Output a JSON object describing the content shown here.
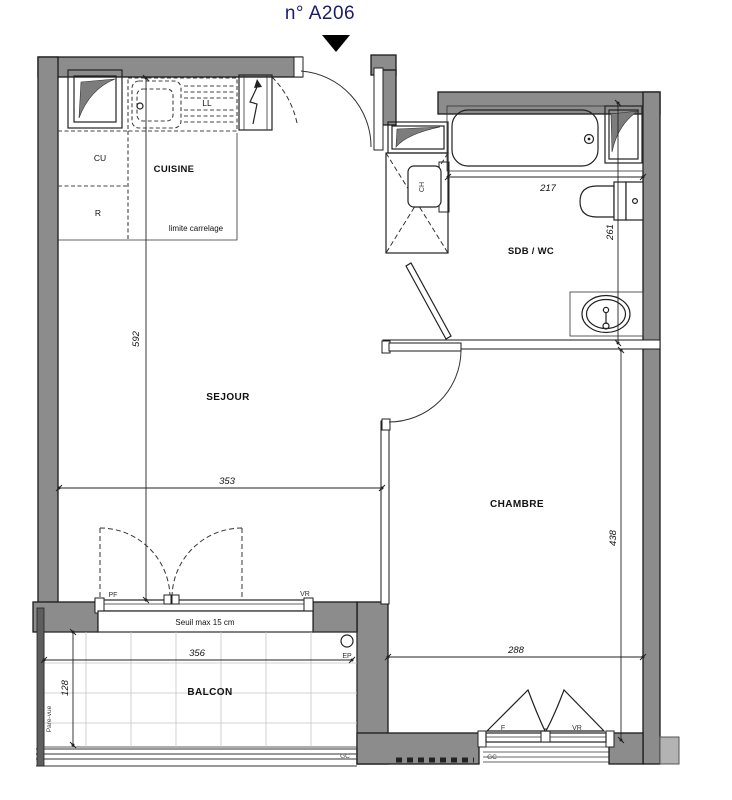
{
  "title": "n° A206",
  "rooms": {
    "cuisine": "CUISINE",
    "sejour": "SEJOUR",
    "sdb_wc": "SDB / WC",
    "chambre": "CHAMBRE",
    "balcon": "BALCON"
  },
  "kitchen": {
    "cu": "CU",
    "r": "R",
    "ll": "LL",
    "limite_carrelage": "limite carrelage"
  },
  "fixtures": {
    "water_heater": "CH"
  },
  "dims": {
    "sejour_h": "592",
    "sejour_w": "353",
    "sdb_w": "217",
    "sdb_h": "261",
    "chambre_h": "438",
    "chambre_w": "288",
    "balcon_w": "356",
    "balcon_d": "128"
  },
  "openings": {
    "pf": "PF",
    "vr_sejour": "VR",
    "f": "F",
    "vr_chambre": "VR",
    "seuil": "Seuil max 15 cm"
  },
  "misc": {
    "ep": "EP",
    "gc_balcon": "GC",
    "gc_chambre": "GC",
    "pare_vue": "Pare-vue"
  },
  "colors": {
    "wall": "#8c8c8c",
    "title": "#1c1c6e",
    "line": "#1a1a1a",
    "grid": "#c4c4c4"
  }
}
